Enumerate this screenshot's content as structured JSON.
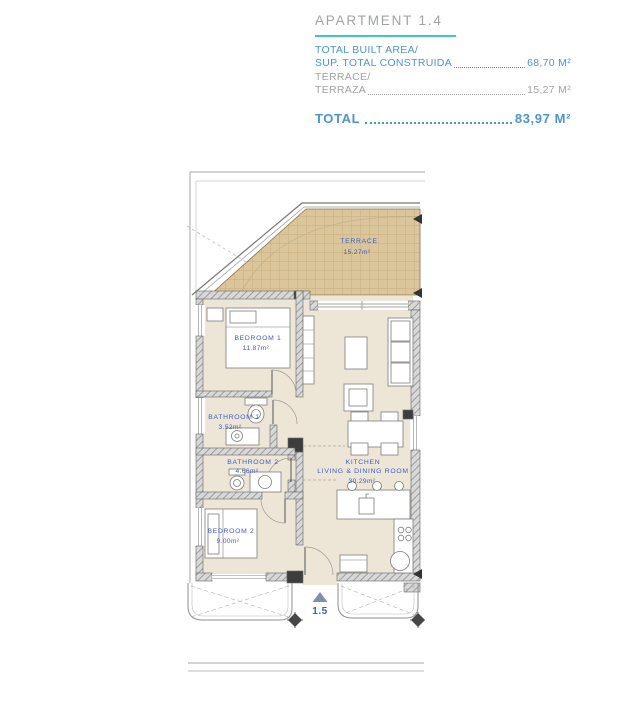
{
  "header": {
    "title": "APARTMENT 1.4",
    "rows": [
      {
        "label_en": "TOTAL BUILT AREA/",
        "label_es": "SUP. TOTAL CONSTRUIDA",
        "value": "68,70 M²"
      },
      {
        "label_en": "TERRACE/",
        "label_es": "TERRAZA",
        "value": "15,27 M²"
      }
    ],
    "total": {
      "label": "TOTAL",
      "value": "83,97 M²"
    }
  },
  "plan": {
    "rooms": {
      "terrace": {
        "name": "TERRACE",
        "area": "15.27m²"
      },
      "bedroom1": {
        "name": "BEDROOM  1",
        "area": "11.87m²"
      },
      "bathroom1": {
        "name": "BATHROOM  1",
        "area": "3.52m²"
      },
      "bathroom2": {
        "name": "BATHROOM  2",
        "area": "4.66m²"
      },
      "bedroom2": {
        "name": "BEDROOM  2",
        "area": "9.00m²"
      },
      "kitchen": {
        "name_line1": "KITCHEN",
        "name_line2": "LIVING  &  DINING  ROOM",
        "area": "30.29m²"
      }
    },
    "next_unit_marker": "1.5"
  },
  "colors": {
    "accent_teal": "#3FC6C9",
    "text_blue": "#4E94CE",
    "text_gray": "#9FA2A4",
    "label_blue": "#3B5BC5",
    "terrace_fill": "#DBC69C",
    "floor_fill": "#EDE6D6"
  }
}
